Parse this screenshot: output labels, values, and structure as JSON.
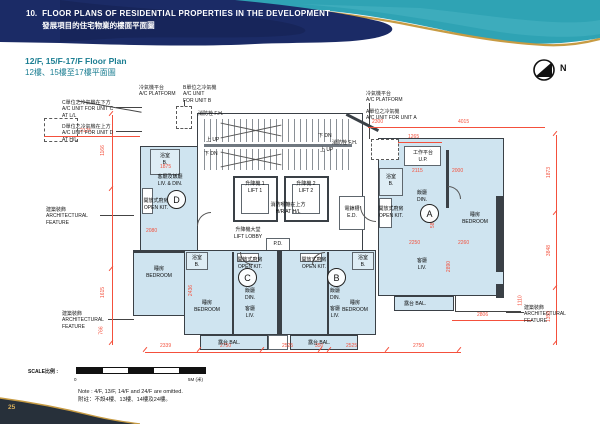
{
  "page": {
    "number": "25"
  },
  "header": {
    "section_no": "10.",
    "title_en": "FLOOR PLANS OF RESIDENTIAL PROPERTIES IN THE DEVELOPMENT",
    "subtitle_zh": "發展項目的住宅物業的樓面平面圖"
  },
  "plan_title": {
    "en": "12/F, 15/F-17/F Floor Plan",
    "zh": "12樓、15樓至17樓平面圖"
  },
  "north": {
    "label": "N"
  },
  "units": {
    "a": "A",
    "b": "B",
    "c": "C",
    "d": "D"
  },
  "rooms": {
    "lift1": {
      "zh": "升降機 1",
      "en": "LIFT 1"
    },
    "lift2": {
      "zh": "升降機 2",
      "en": "LIFT 2"
    },
    "lift_lobby": {
      "zh": "升降機大堂",
      "en": "LIFT LOBBY"
    },
    "liv_din": {
      "zh": "客廳及飯廳",
      "en": "LIV. & DIN."
    },
    "open_kit": {
      "zh": "開放式廚房",
      "en": "OPEN KIT."
    },
    "bedroom": {
      "zh": "睡房",
      "en": "BEDROOM"
    },
    "bath": {
      "zh": "浴室",
      "en": "B."
    },
    "din": {
      "zh": "飯廳",
      "en": "DIN."
    },
    "liv": {
      "zh": "客廳",
      "en": "LIV."
    },
    "bal": {
      "zh": "露台",
      "en": "BAL."
    },
    "up_platform": {
      "zh": "工作平台",
      "en": "U.P."
    },
    "hose_reel": {
      "zh": "消防喉轆在上方",
      "en": "H/R AT H/L"
    },
    "elec_duct": {
      "zh": "電錶槽",
      "en": "E.D."
    },
    "pipe_duct": {
      "en": "P.D."
    },
    "fire_hydrant": {
      "zh": "消防栓",
      "en": "F.H."
    },
    "up": "上 UP",
    "dn": "下 DN"
  },
  "callouts": {
    "ac_platform": {
      "zh": "冷氣機平台",
      "en": "A/C PLATFORM"
    },
    "ac_unit_b": {
      "zh": "B單位之冷氣機",
      "en": "A/C UNIT",
      "en2": "FOR UNIT B"
    },
    "ac_unit_a": {
      "zh": "A單位之冷氣機",
      "en": "A/C UNIT FOR UNIT A"
    },
    "ac_unit_c": {
      "zh": "C單位之冷氣機在下方",
      "en": "A/C UNIT FOR UNIT C",
      "en2": "AT L/L"
    },
    "ac_unit_d": {
      "zh": "D單位之冷氣機在上方",
      "en": "A/C UNIT FOR UNIT D",
      "en2": "AT H/L"
    },
    "arch_feature": {
      "zh": "建築裝飾",
      "en": "ARCHITECTURAL",
      "en2": "FEATURE"
    }
  },
  "dims": {
    "top": [
      "2125",
      "2300",
      "4015",
      "1265"
    ],
    "bottom": [
      "2339",
      "2750",
      "2525",
      "350",
      "2525",
      "2750",
      "2806"
    ],
    "right": [
      "1873",
      "3848",
      "1358",
      "1110"
    ],
    "left": [
      "1166",
      "1615",
      "766"
    ],
    "inner": [
      "1875",
      "2080",
      "2115",
      "2000",
      "2250",
      "2260",
      "5876",
      "2890",
      "2436"
    ]
  },
  "scale": {
    "label": "SCALE比例 :",
    "zero": "0",
    "five": "5M (米)"
  },
  "note": {
    "en": "Note : 4/F, 13/F, 14/F and 24/F are omitted.",
    "zh": "附註：不設4樓、13樓、14樓及24樓。"
  },
  "colors": {
    "navy": "#1B2B66",
    "teal": "#2FA3B4",
    "gold": "#C79B43",
    "dim_red": "#F4503C",
    "wall": "#3A4046",
    "room_fill": "#CFE4F0",
    "title_teal": "#1B7E92"
  }
}
